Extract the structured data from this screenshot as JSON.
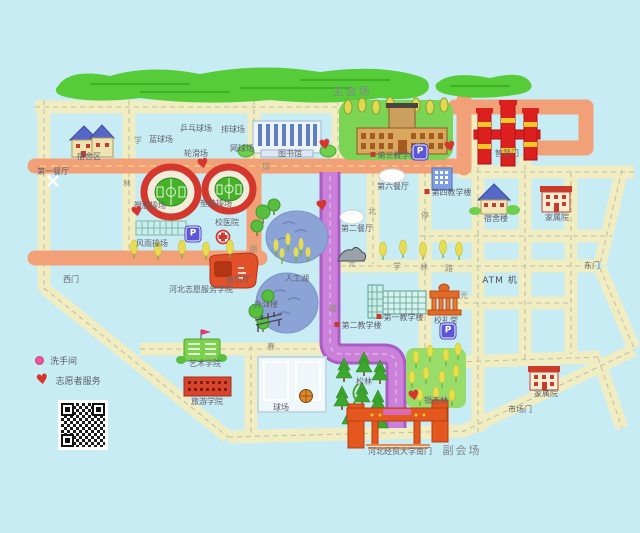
{
  "venue": {
    "main": "主会场",
    "sub": "副会场"
  },
  "legend": {
    "restroom": "洗手间",
    "volunteer": "志愿者服务"
  },
  "icons": {
    "heart": "♥",
    "parking": "P"
  },
  "colors": {
    "background": "#c8ecf4",
    "road_yellow": "#f0edc3",
    "road_orange": "#f1a077",
    "road_purple": "#cb80da",
    "forest_green": "#56cd38",
    "heart_red": "#d6342c",
    "parking_blue": "#5b55d8",
    "restroom_pink": "#e8559a",
    "stadium_ring": "#d4372c",
    "field_green": "#46b22a",
    "lake_blue": "#8ca3d6",
    "gate_red": "#dc1f1f",
    "south_gate_orange": "#e4571f"
  },
  "map_labels": [
    {
      "t": "主会场",
      "x": 352,
      "y": 86,
      "cls": "big"
    },
    {
      "t": "副会场",
      "x": 462,
      "y": 445,
      "cls": "big"
    },
    {
      "t": "宿舍区",
      "x": 89,
      "y": 153
    },
    {
      "t": "第一餐厅",
      "x": 53,
      "y": 168
    },
    {
      "t": "乒乓球场",
      "x": 196,
      "y": 125
    },
    {
      "t": "排球场",
      "x": 233,
      "y": 126
    },
    {
      "t": "蓝球场",
      "x": 161,
      "y": 136
    },
    {
      "t": "轮滑场",
      "x": 196,
      "y": 150
    },
    {
      "t": "网球场",
      "x": 242,
      "y": 145
    },
    {
      "t": "图书馆",
      "x": 290,
      "y": 150
    },
    {
      "t": "第三教学楼",
      "x": 394,
      "y": 152,
      "cls": "dot"
    },
    {
      "t": "智慧门",
      "x": 507,
      "y": 150
    },
    {
      "t": "第六餐厅",
      "x": 393,
      "y": 183
    },
    {
      "t": "第四教学楼",
      "x": 448,
      "y": 189,
      "cls": "dot"
    },
    {
      "t": "宿舍楼",
      "x": 496,
      "y": 215
    },
    {
      "t": "家属院",
      "x": 557,
      "y": 214
    },
    {
      "t": "校医院",
      "x": 227,
      "y": 219
    },
    {
      "t": "风雨操场",
      "x": 152,
      "y": 240
    },
    {
      "t": "音乐厅",
      "x": 238,
      "y": 276
    },
    {
      "t": "河北志愿服务学院",
      "x": 201,
      "y": 286
    },
    {
      "t": "西门",
      "x": 71,
      "y": 276
    },
    {
      "t": "人工湖",
      "x": 297,
      "y": 275
    },
    {
      "t": "第二餐厅",
      "x": 357,
      "y": 225
    },
    {
      "t": "办公楼",
      "x": 266,
      "y": 301
    },
    {
      "t": "第一教学楼",
      "x": 400,
      "y": 314,
      "cls": "dot"
    },
    {
      "t": "第二教学楼",
      "x": 358,
      "y": 322,
      "cls": "dot"
    },
    {
      "t": "校礼堂",
      "x": 446,
      "y": 317
    },
    {
      "t": "ATM 机",
      "x": 500,
      "y": 277,
      "cls": "atm"
    },
    {
      "t": "东门",
      "x": 592,
      "y": 262
    },
    {
      "t": "艺术学院",
      "x": 205,
      "y": 360
    },
    {
      "t": "旅游学院",
      "x": 207,
      "y": 398
    },
    {
      "t": "球场",
      "x": 281,
      "y": 404
    },
    {
      "t": "松林",
      "x": 364,
      "y": 378
    },
    {
      "t": "银杏林",
      "x": 436,
      "y": 397
    },
    {
      "t": "家属院",
      "x": 546,
      "y": 390
    },
    {
      "t": "市场门",
      "x": 520,
      "y": 406
    },
    {
      "t": "河北经贸大学南门",
      "x": 400,
      "y": 448
    },
    {
      "t": "塑胶操场",
      "x": 150,
      "y": 202,
      "cls": "under"
    },
    {
      "t": "塑胶操场",
      "x": 216,
      "y": 200,
      "cls": "under"
    }
  ],
  "road_chars": [
    {
      "t": "学",
      "x": 138,
      "y": 135
    },
    {
      "t": "林",
      "x": 127,
      "y": 178
    },
    {
      "t": "综",
      "x": 266,
      "y": 161
    },
    {
      "t": "湖",
      "x": 253,
      "y": 244
    },
    {
      "t": "北",
      "x": 372,
      "y": 206
    },
    {
      "t": "停",
      "x": 425,
      "y": 210
    },
    {
      "t": "光",
      "x": 352,
      "y": 258
    },
    {
      "t": "学",
      "x": 397,
      "y": 261
    },
    {
      "t": "林",
      "x": 424,
      "y": 262
    },
    {
      "t": "路",
      "x": 449,
      "y": 263
    },
    {
      "t": "光",
      "x": 464,
      "y": 290
    },
    {
      "t": "春",
      "x": 271,
      "y": 341
    },
    {
      "t": "路",
      "x": 333,
      "y": 303
    }
  ],
  "hearts": [
    {
      "x": 203,
      "y": 165
    },
    {
      "x": 137,
      "y": 213
    },
    {
      "x": 322,
      "y": 207
    },
    {
      "x": 325,
      "y": 146
    },
    {
      "x": 450,
      "y": 148
    },
    {
      "x": 414,
      "y": 397
    }
  ],
  "parkings": [
    {
      "x": 420,
      "y": 152
    },
    {
      "x": 193,
      "y": 234
    },
    {
      "x": 448,
      "y": 331
    }
  ]
}
